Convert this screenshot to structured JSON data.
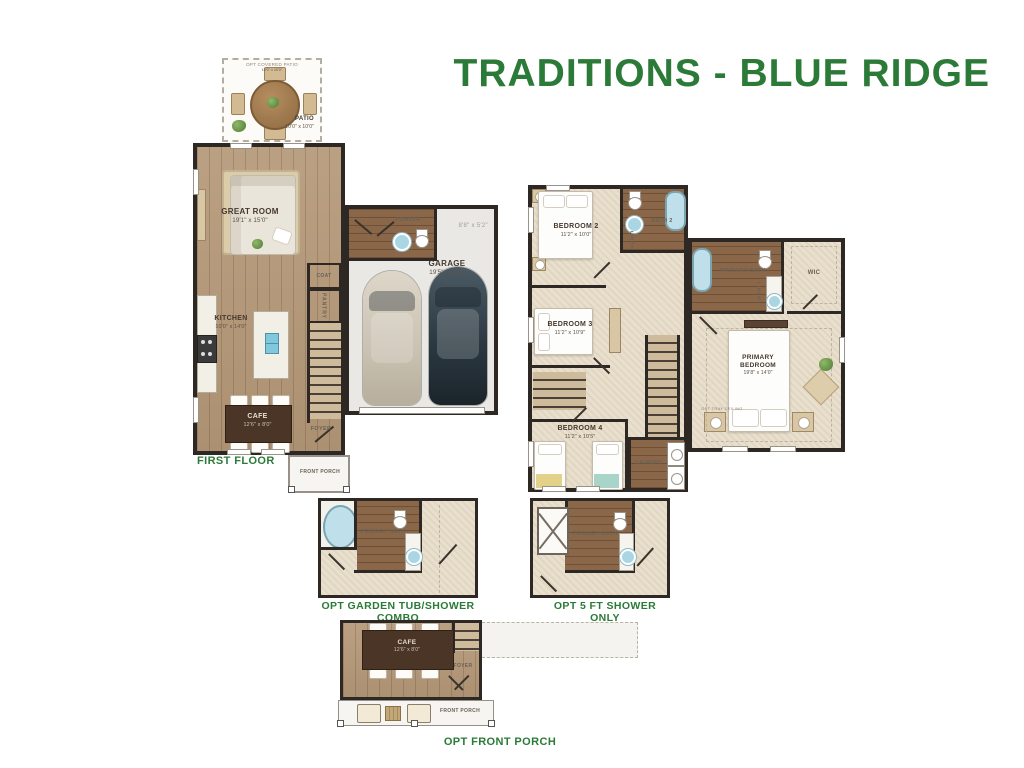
{
  "title": "TRADITIONS - BLUE RIDGE",
  "colors": {
    "brand_green": "#2b7a38",
    "wall": "#2d2823",
    "wood_floor": "#b59878",
    "dark_wood_floor": "#8a6748",
    "carpet": "#e9dfcd",
    "tub_blue": "#bfe0ea"
  },
  "first_floor": {
    "caption": "FIRST FLOOR",
    "patio": {
      "label": "PATIO",
      "dims": "10'0\" x 10'0\"",
      "opt_note": "OPT COVERED PATIO",
      "opt_dims": "10'0\" x 10'0\""
    },
    "great_room": {
      "label": "GREAT ROOM",
      "dims": "19'1\" x 15'0\""
    },
    "kitchen": {
      "label": "KITCHEN",
      "dims": "10'0\" x 14'0\""
    },
    "cafe": {
      "label": "CAFE",
      "dims": "12'6\" x 8'0\""
    },
    "powder": {
      "label": "POWDER"
    },
    "coat": {
      "label": "COAT"
    },
    "pantry": {
      "label": "PANTRY"
    },
    "foyer": {
      "label": "FOYER"
    },
    "front_porch": {
      "label": "FRONT PORCH"
    },
    "garage": {
      "label": "GARAGE",
      "dims": "19'5\" x 20'2\"",
      "corner_dims": "8'8\" x 5'2\""
    }
  },
  "second_floor": {
    "bedroom2": {
      "label": "BEDROOM 2",
      "dims": "11'2\" x 10'0\""
    },
    "bath2": {
      "label": "BATH 2"
    },
    "linen": {
      "label": "LINEN"
    },
    "bedroom3": {
      "label": "BEDROOM 3",
      "dims": "11'2\" x 10'9\""
    },
    "primary_bath": {
      "label": "PRIMARY BATH"
    },
    "wic": {
      "label": "WIC"
    },
    "primary_bedroom": {
      "label": "PRIMARY BEDROOM",
      "dims": "19'8\" x 14'0\"",
      "opt_note": "OPT TRAY CEILING"
    },
    "bedroom4": {
      "label": "BEDROOM 4",
      "dims": "11'2\" x 10'5\""
    },
    "laundry": {
      "label": "LAUNDRY"
    }
  },
  "options": {
    "garden_tub": {
      "caption": "OPT GARDEN TUB/SHOWER COMBO",
      "room": "PRIMARY BATH"
    },
    "shower_only": {
      "caption": "OPT 5 FT SHOWER ONLY",
      "room": "PRIMARY BATH"
    },
    "front_porch": {
      "caption": "OPT FRONT PORCH",
      "cafe_label": "CAFE",
      "cafe_dims": "12'6\" x 8'0\"",
      "foyer": "FOYER",
      "porch": "FRONT PORCH"
    }
  }
}
